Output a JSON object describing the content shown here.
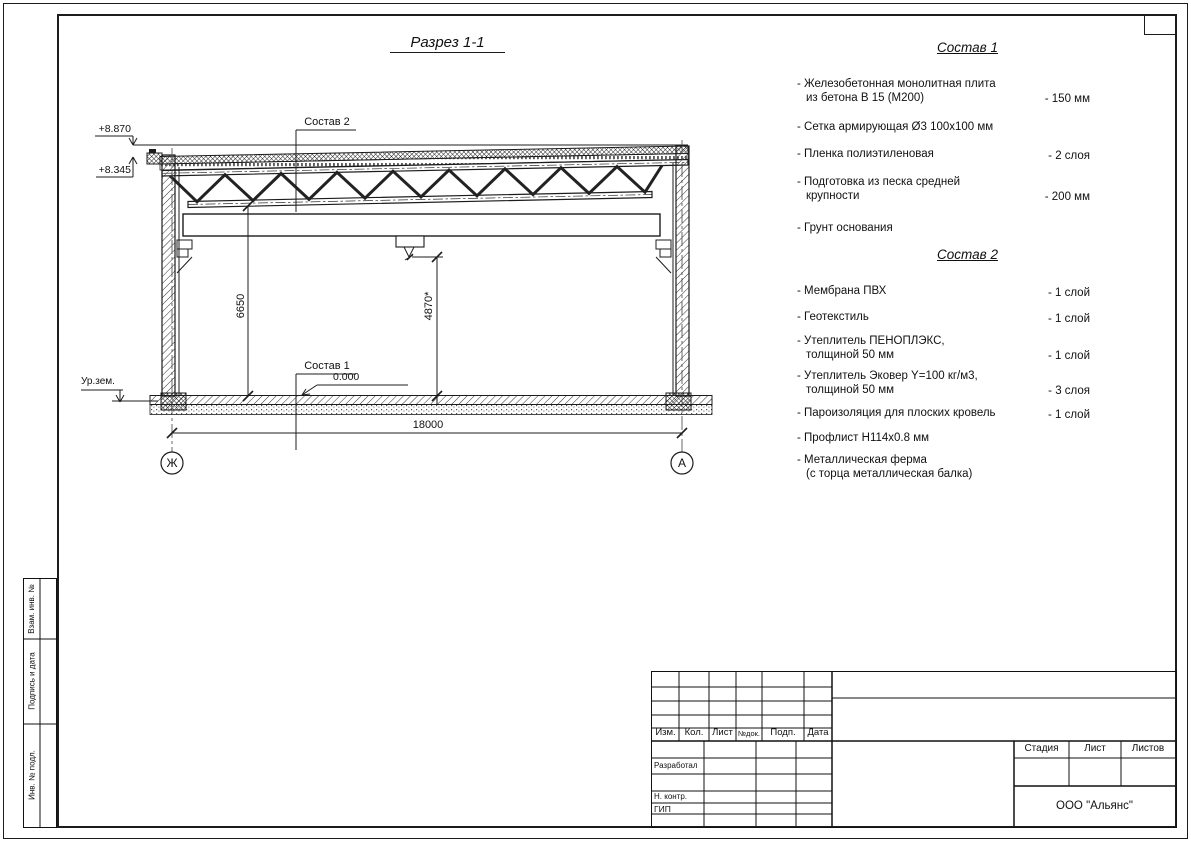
{
  "drawing": {
    "title": "Разрез 1-1",
    "labels": {
      "sostav2_leader": "Состав 2",
      "sostav1_leader": "Состав 1",
      "elev_top": "+8.870",
      "elev_mid": "+8.345",
      "elev_zero": "0.000",
      "ground": "Ур.зем.",
      "dim_height_left": "6650",
      "dim_height_mid": "4870*",
      "dim_span": "18000",
      "axis_left": "Ж",
      "axis_right": "А"
    }
  },
  "sostav1": {
    "title": "Состав 1",
    "items": [
      {
        "name1": "- Железобетонная  монолитная плита",
        "name2": "из бетона В 15 (М200)",
        "value": "- 150 мм"
      },
      {
        "name1": "- Сетка армирующая Ø3 100х100 мм",
        "name2": "",
        "value": ""
      },
      {
        "name1": "- Пленка полиэтиленовая",
        "name2": "",
        "value": "- 2 слоя"
      },
      {
        "name1": "- Подготовка из песка средней",
        "name2": "крупности",
        "value": "- 200 мм"
      },
      {
        "name1": "- Грунт основания",
        "name2": "",
        "value": ""
      }
    ]
  },
  "sostav2": {
    "title": "Состав 2",
    "items": [
      {
        "name1": "- Мембрана ПВХ",
        "name2": "",
        "value": "- 1 слой"
      },
      {
        "name1": "- Геотекстиль",
        "name2": "",
        "value": "- 1 слой"
      },
      {
        "name1": "- Утеплитель ПЕНОПЛЭКС,",
        "name2": "толщиной 50 мм",
        "value": "- 1 слой"
      },
      {
        "name1": "- Утеплитель Эковер Y=100 кг/м3,",
        "name2": "толщиной 50 мм",
        "value": "- 3 слоя"
      },
      {
        "name1": "- Пароизоляция для плоских кровель",
        "name2": "",
        "value": "- 1 слой"
      },
      {
        "name1": "- Профлист Н114х0.8 мм",
        "name2": "",
        "value": ""
      },
      {
        "name1": "- Металлическая ферма",
        "name2": "(с торца металлическая балка)",
        "value": ""
      }
    ]
  },
  "titleblock": {
    "change_header": [
      "Изм.",
      "Кол.",
      "Лист",
      "№док.",
      "Подп.",
      "Дата"
    ],
    "roles": [
      "Разработал",
      "Н. контр.",
      "ГИП"
    ],
    "stage_header": [
      "Стадия",
      "Лист",
      "Листов"
    ],
    "company": "ООО \"Альянс\""
  },
  "side_strip": {
    "cells": [
      "Взам. инв. №",
      "Подпись и дата",
      "Инв. № подл."
    ]
  }
}
